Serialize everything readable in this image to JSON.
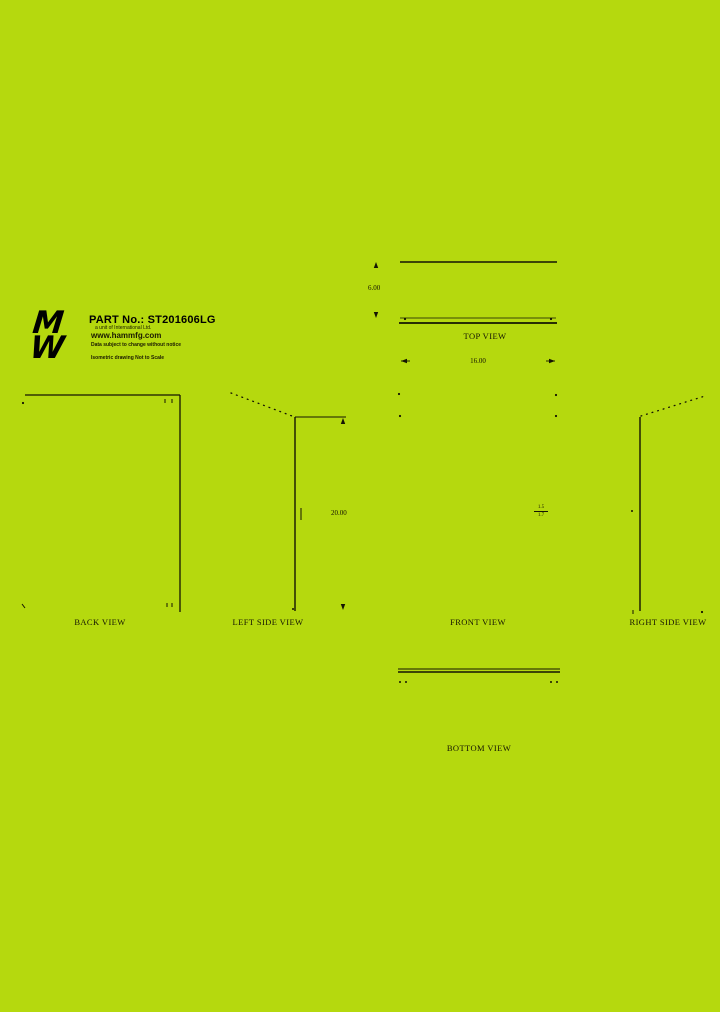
{
  "page": {
    "background_color": "#b5d90e",
    "line_color": "#151503"
  },
  "title_block": {
    "logo_top_glyph": "M",
    "logo_bottom_glyph": "W",
    "part_label": "PART No.: ST201606LG",
    "subtitle": "a unit of International Ltd.",
    "website": "www.hammfg.com",
    "notice": "Data subject to change without notice",
    "scale_note": "Isometric drawing Not to Scale"
  },
  "views": {
    "top": {
      "label": "TOP VIEW",
      "dim_width": "16.00",
      "dim_depth": "6.00"
    },
    "back": {
      "label": "BACK VIEW"
    },
    "left": {
      "label": "LEFT SIDE VIEW",
      "dim_height": "20.00"
    },
    "front": {
      "label": "FRONT VIEW",
      "note_top": "1.5",
      "note_bottom": "1.7"
    },
    "right": {
      "label": "RIGHT SIDE VIEW"
    },
    "bottom": {
      "label": "BOTTOM VIEW"
    }
  }
}
